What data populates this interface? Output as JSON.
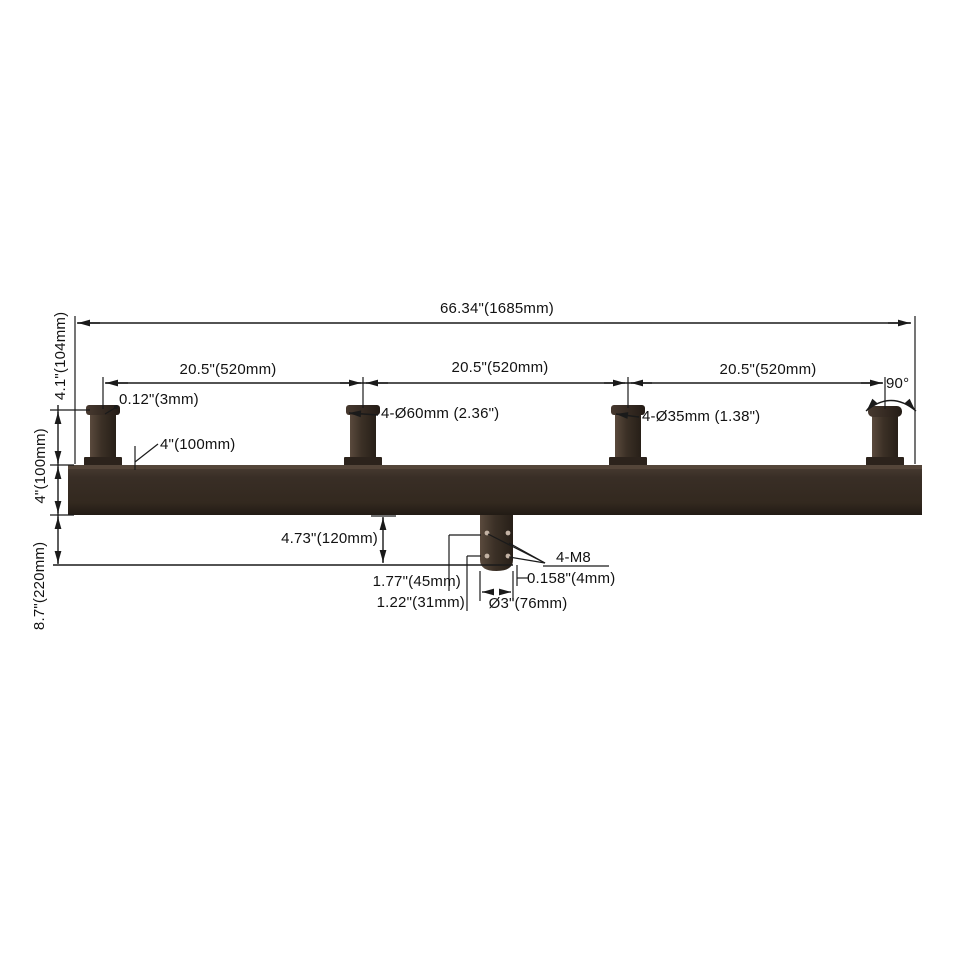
{
  "drawing": {
    "description": "Quad square-bar tenon bracket / bullhorn pole adapter dimension diagram",
    "dims": {
      "total_width": "66.34\"(1685mm)",
      "spacing_1": "20.5\"(520mm)",
      "spacing_2": "20.5\"(520mm)",
      "spacing_3": "20.5\"(520mm)",
      "tenon_lip": "0.12\"(3mm)",
      "tenon_od_large": "4-Ø60mm (2.36\")",
      "tenon_od_small": "4-Ø35mm (1.38\")",
      "tenon_angle": "90°",
      "tenon_height": "4.1\"(104mm)",
      "bar_height": "4\"(100mm)",
      "bar_side": "4\"(100mm)",
      "below_bar_total": "8.7\"(220mm)",
      "slipfitter_depth": "4.73\"(120mm)",
      "bolt_upper_offset": "1.77\"(45mm)",
      "bolt_lower_offset": "1.22\"(31mm)",
      "wall_thickness": "0.158\"(4mm)",
      "slipfitter_id": "Ø3\"(76mm)",
      "bolt_spec": "4-M8"
    },
    "colors": {
      "line": "#1a1a1a",
      "metal_light": "#55463b",
      "metal_mid": "#3a2f27",
      "metal_dark": "#251d18",
      "background": "#ffffff"
    }
  }
}
